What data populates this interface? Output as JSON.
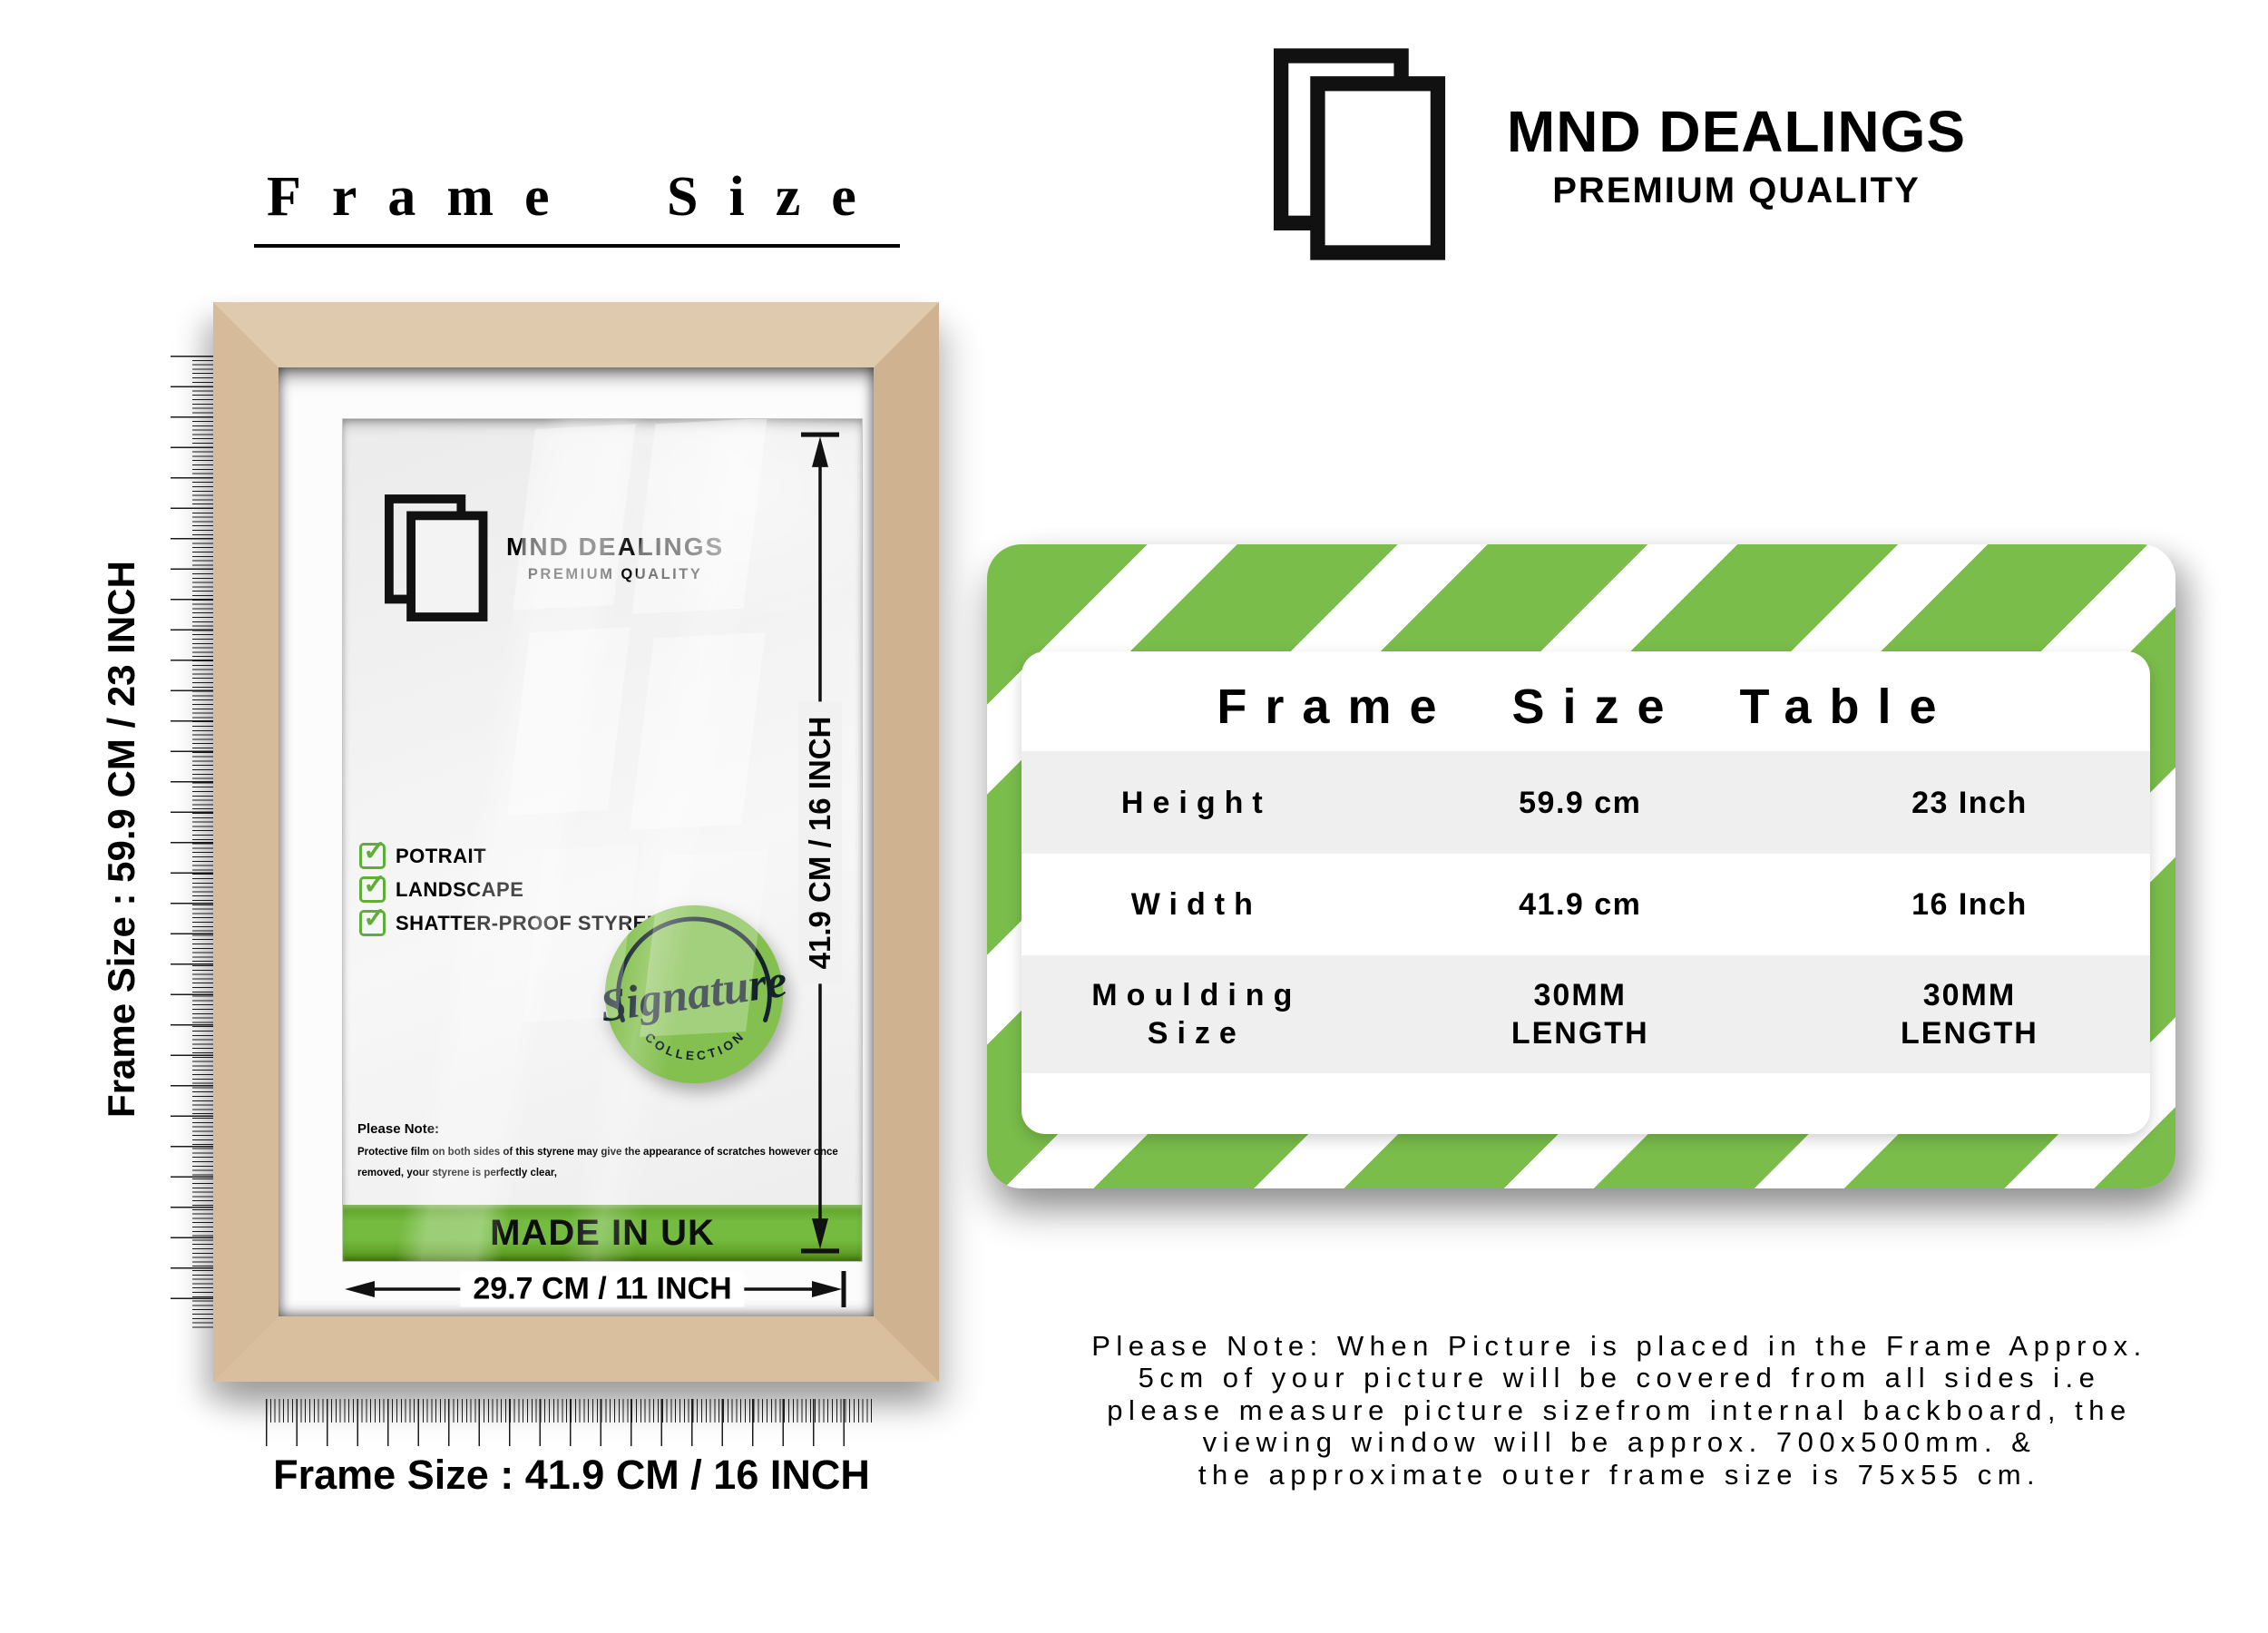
{
  "title": "Frame Size",
  "brand": {
    "name": "MND DEALINGS",
    "tagline": "PREMIUM QUALITY"
  },
  "frame_labels": {
    "left": "Frame Size : 59.9 CM / 23 INCH",
    "bottom": "Frame Size : 41.9 CM / 16 INCH",
    "inner_height": "41.9 CM / 16 INCH",
    "inner_width": "29.7 CM / 11 INCH"
  },
  "panel": {
    "features": [
      "POTRAIT",
      "LANDSCAPE",
      "SHATTER-PROOF STYRENE"
    ],
    "badge": {
      "word": "Signature",
      "arc": "C O L L E C T I O N"
    },
    "note_title": "Please Note:",
    "note_line1": "Protective film on both sides of this styrene may give the appearance of scratches however once",
    "note_line2": "removed, your styrene is perfectly clear,",
    "made_in": "MADE IN UK"
  },
  "size_table": {
    "title": "Frame Size Table",
    "rows": [
      {
        "label": "Height",
        "metric": "59.9 cm",
        "imperial": "23 Inch"
      },
      {
        "label": "Width",
        "metric": "41.9 cm",
        "imperial": "16 Inch"
      },
      {
        "label": "Moulding Size",
        "metric": "30MM LENGTH",
        "imperial": "30MM LENGTH"
      }
    ]
  },
  "footer_note": {
    "line1": "Please Note: When Picture is placed in the Frame Approx.",
    "line2": "5cm of your picture will be covered from all sides i.e",
    "line3": "please measure picture sizefrom internal backboard, the",
    "line4": "viewing window will be approx. 700x500mm. &",
    "line5": "the approximate outer frame size is 75x55 cm."
  },
  "icons": {
    "check": "✓"
  },
  "colors": {
    "stripe_green": "#7abd4a",
    "badge_green": "#84c04f",
    "check_green": "#5fae3a",
    "made_bar_green": "#6fb53b",
    "wood": "#d9c0a0",
    "row_gray": "#efefef"
  }
}
